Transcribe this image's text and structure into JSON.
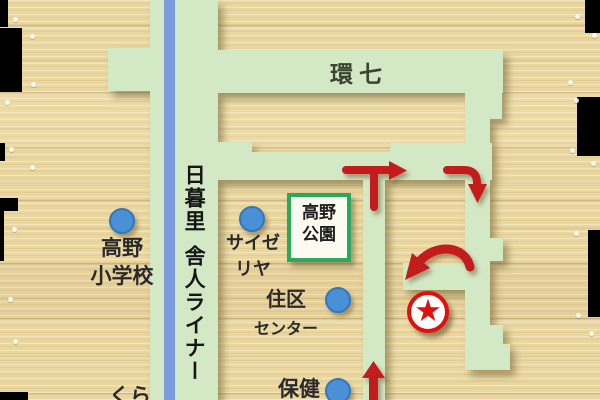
{
  "map": {
    "type": "hand-drawn access map",
    "main_road_label": "環七",
    "railway": {
      "line1": "日暮里",
      "line2": "舎人ライナー"
    },
    "pois": [
      {
        "id": "koya-elementary-school",
        "label_line1": "高野",
        "label_line2": "小学校"
      },
      {
        "id": "saizeriya",
        "label_line1": "サイゼ",
        "label_line2": "リヤ"
      },
      {
        "id": "koya-park",
        "label_line1": "高野",
        "label_line2": "公園"
      },
      {
        "id": "juku-center",
        "label_line1": "住区",
        "label_line2": "センター"
      },
      {
        "id": "hoken",
        "label_line1": "保健",
        "label_line2": ""
      },
      {
        "id": "kura",
        "label_line1": "くら",
        "label_line2": ""
      }
    ],
    "destination_marker": {
      "symbol": "★"
    },
    "colors": {
      "wood": "#ead7a0",
      "road_green": "#d3e8c5",
      "railway_blue": "#7d9ce0",
      "poi_dot_blue": "#4a90d6",
      "route_red": "#c41c1c",
      "park_border_green": "#29a85e",
      "star_red": "#e01010"
    }
  }
}
